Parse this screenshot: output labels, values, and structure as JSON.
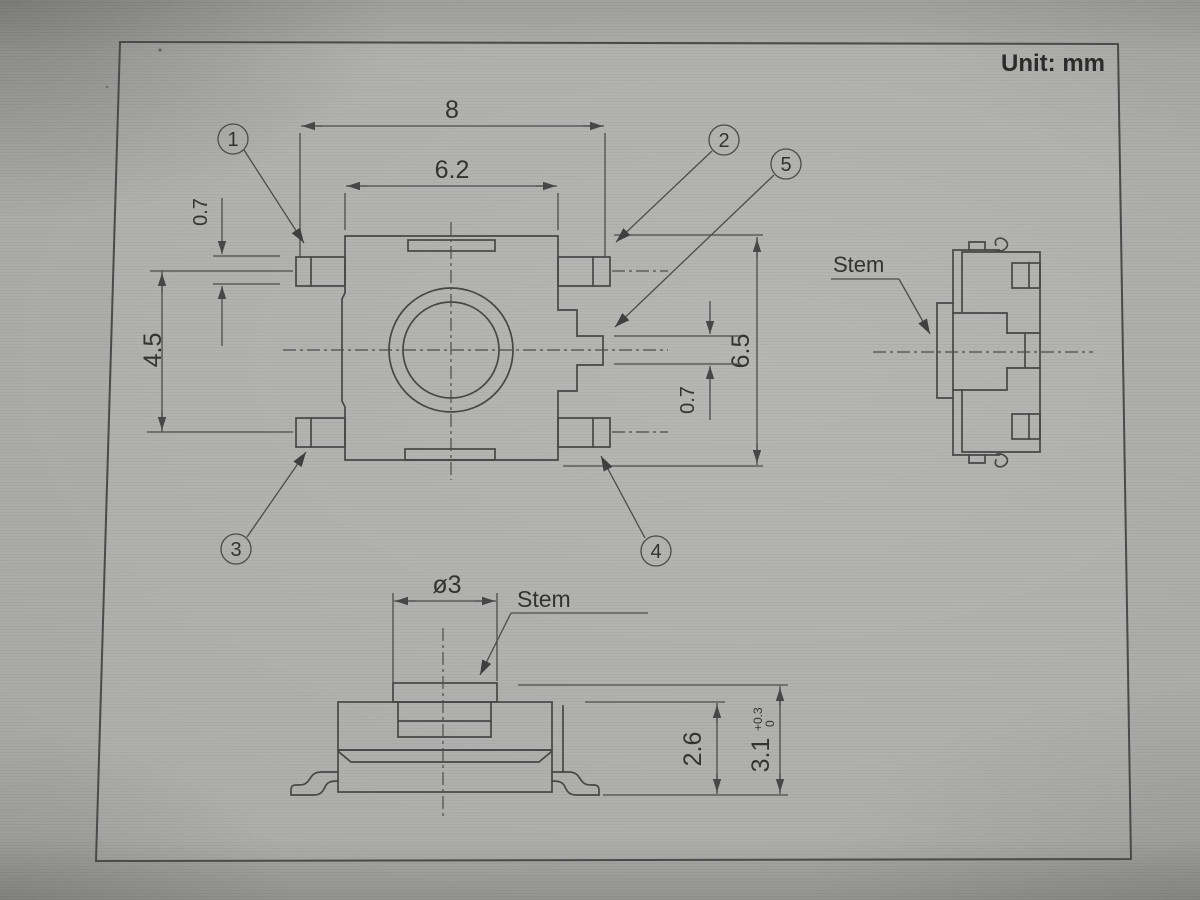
{
  "unit_label": "Unit: mm",
  "top_view": {
    "dims": {
      "overall_width": "8",
      "body_width": "6.2",
      "lead_width": "0.7",
      "lead_row_spacing": "4.5",
      "overall_depth": "6.5",
      "center_lead_width": "0.7"
    },
    "callouts": [
      {
        "label": "1"
      },
      {
        "label": "2"
      },
      {
        "label": "3"
      },
      {
        "label": "4"
      },
      {
        "label": "5"
      }
    ]
  },
  "side_view": {
    "stem_label": "Stem"
  },
  "front_view": {
    "stem_label": "Stem",
    "dims": {
      "stem_diameter": "ø3",
      "housing_height": "2.6",
      "overall_height": {
        "value": "3.1",
        "tol_upper": "+0.3",
        "tol_lower": "0"
      }
    }
  }
}
